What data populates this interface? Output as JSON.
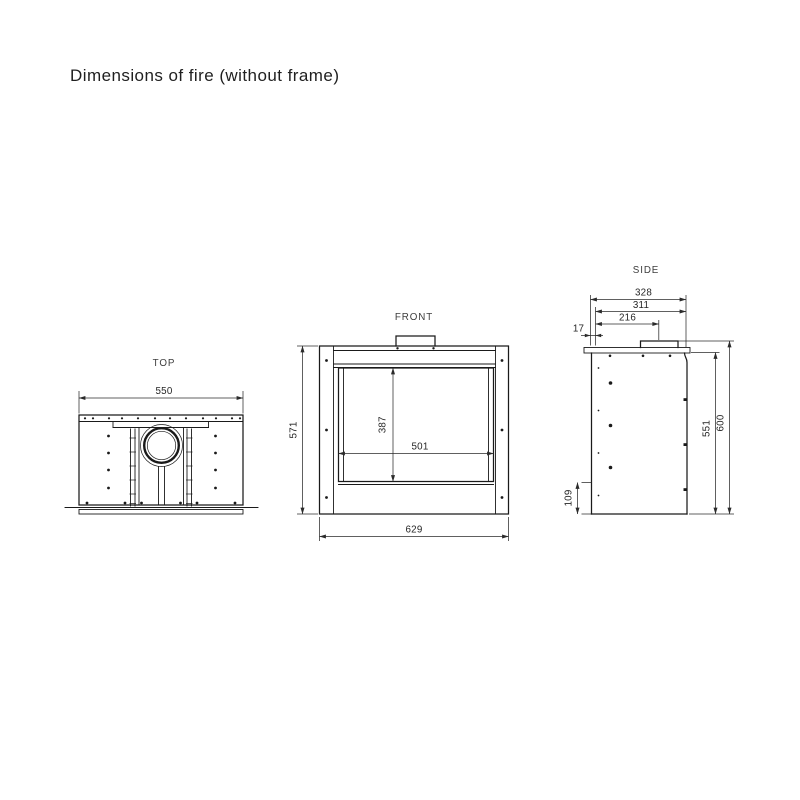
{
  "title": "Dimensions of fire (without frame)",
  "views": {
    "top": {
      "label": "TOP",
      "dims": {
        "width": "550"
      }
    },
    "front": {
      "label": "FRONT",
      "dims": {
        "overall_width": "629",
        "overall_height": "571",
        "glass_width": "501",
        "glass_height": "387"
      }
    },
    "side": {
      "label": "SIDE",
      "dims": {
        "depth_overall": "328",
        "depth_less_front": "311",
        "flue_centre_from_front": "216",
        "front_lip": "17",
        "body_height": "551",
        "overall_height": "600",
        "base_height": "109"
      }
    }
  },
  "colors": {
    "line": "#1a1a1a",
    "dimension": "#2b2b2b",
    "text": "#262626",
    "background": "#ffffff"
  }
}
